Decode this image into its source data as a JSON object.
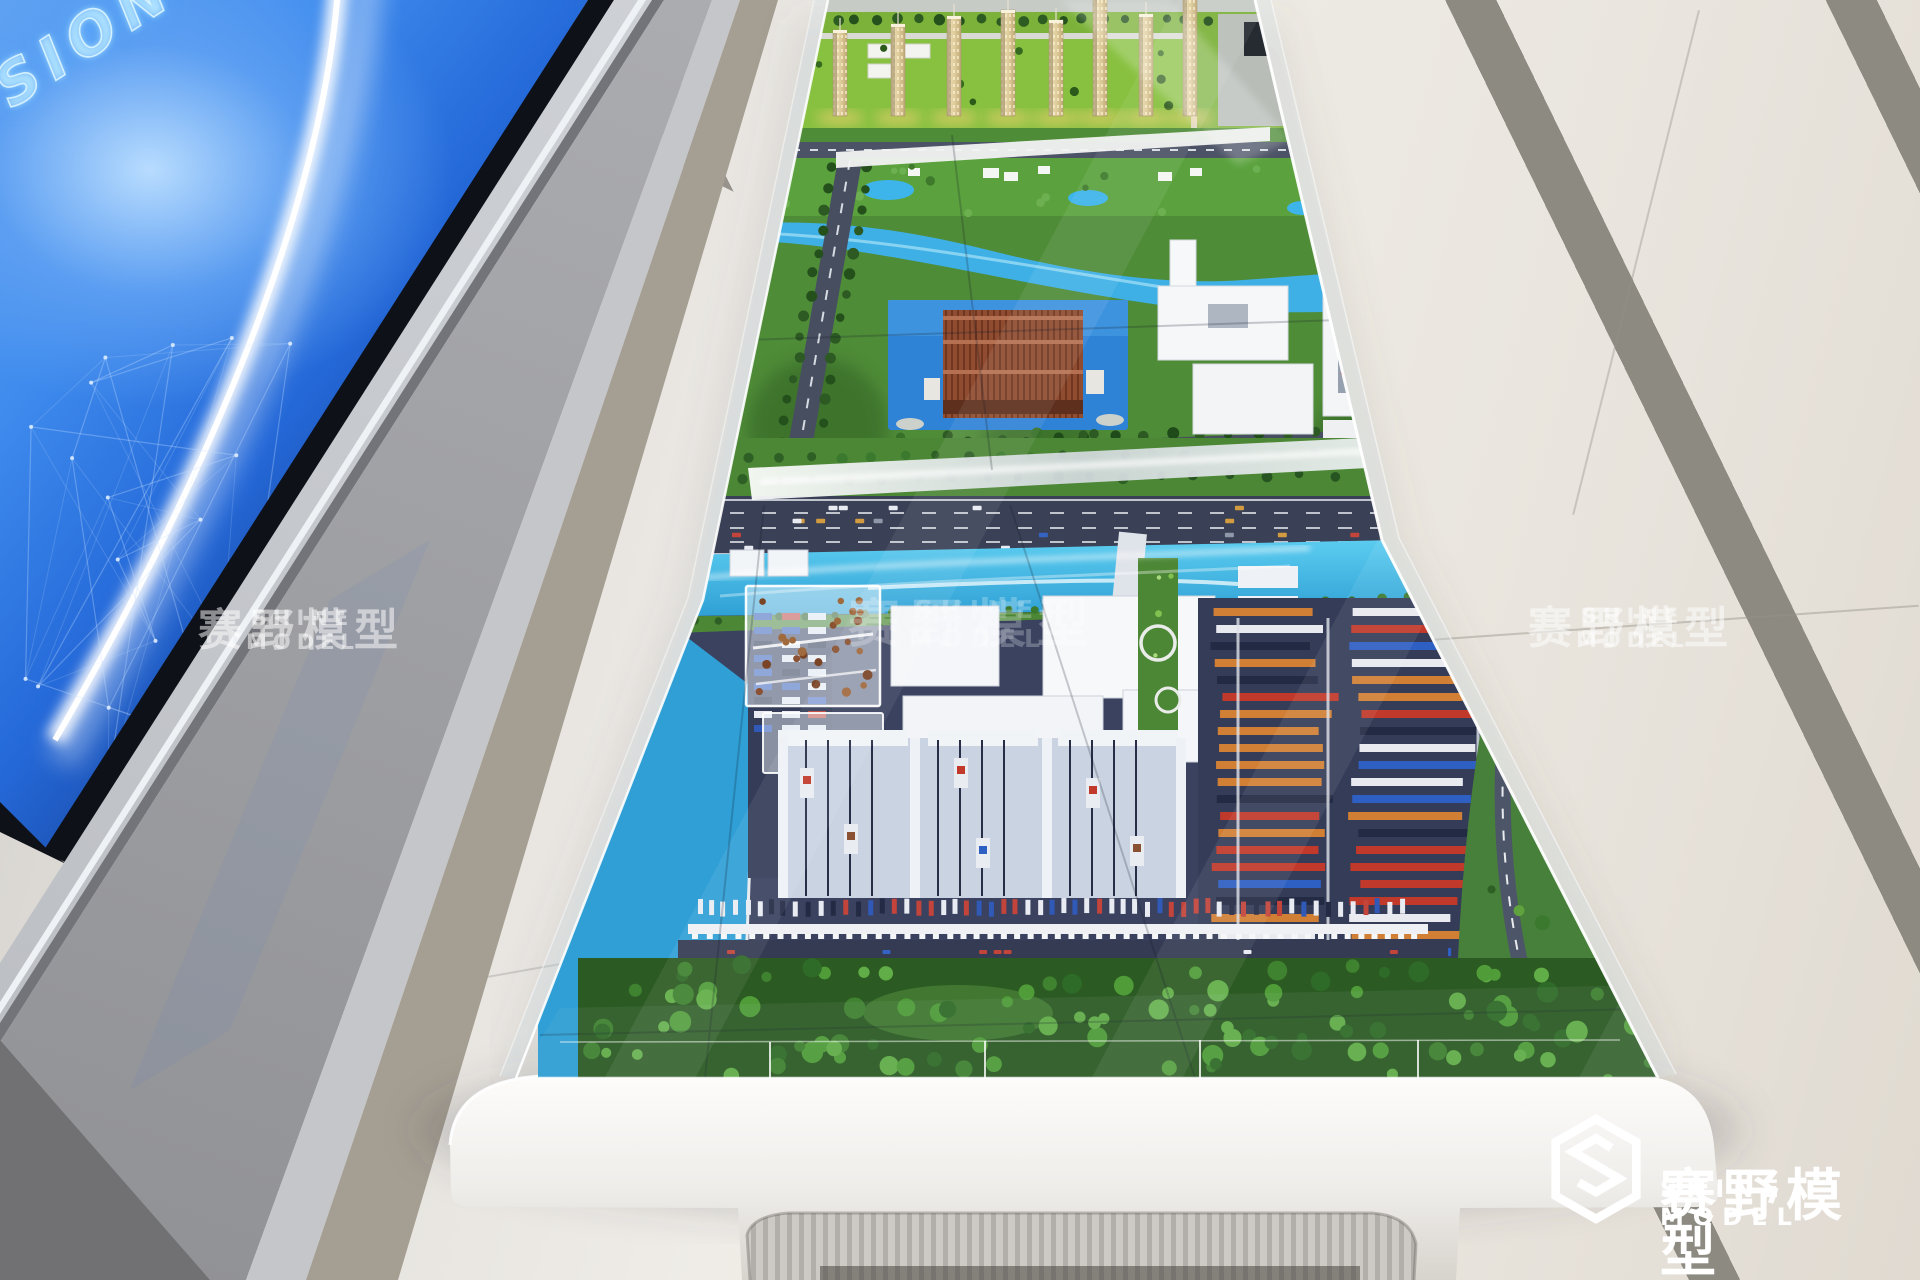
{
  "led_screen": {
    "glow_text": "SION INNO",
    "accent_blue": "#2f7be4",
    "dark_navy": "#0a1430"
  },
  "watermark": {
    "cn": "赛野模型",
    "en": "SHINE MODEL"
  },
  "brand_logo": {
    "cn": "赛野模型",
    "en": "SHINE MODEL",
    "icon": "hexagon-s-logo"
  },
  "colors": {
    "floor": "#ece9e3",
    "floor_stripe": "#8d8a82",
    "walkway": "#a9abaf",
    "table_white": "#f4f2ef",
    "lawn": "#7cb23a",
    "park_green": "#4f8c38",
    "river": "#3fb0e6",
    "canal": "#54c4ec",
    "harbor_water": "#2f9fd6",
    "industrial_base": "#3a4260",
    "forest": "#2c5a23"
  }
}
